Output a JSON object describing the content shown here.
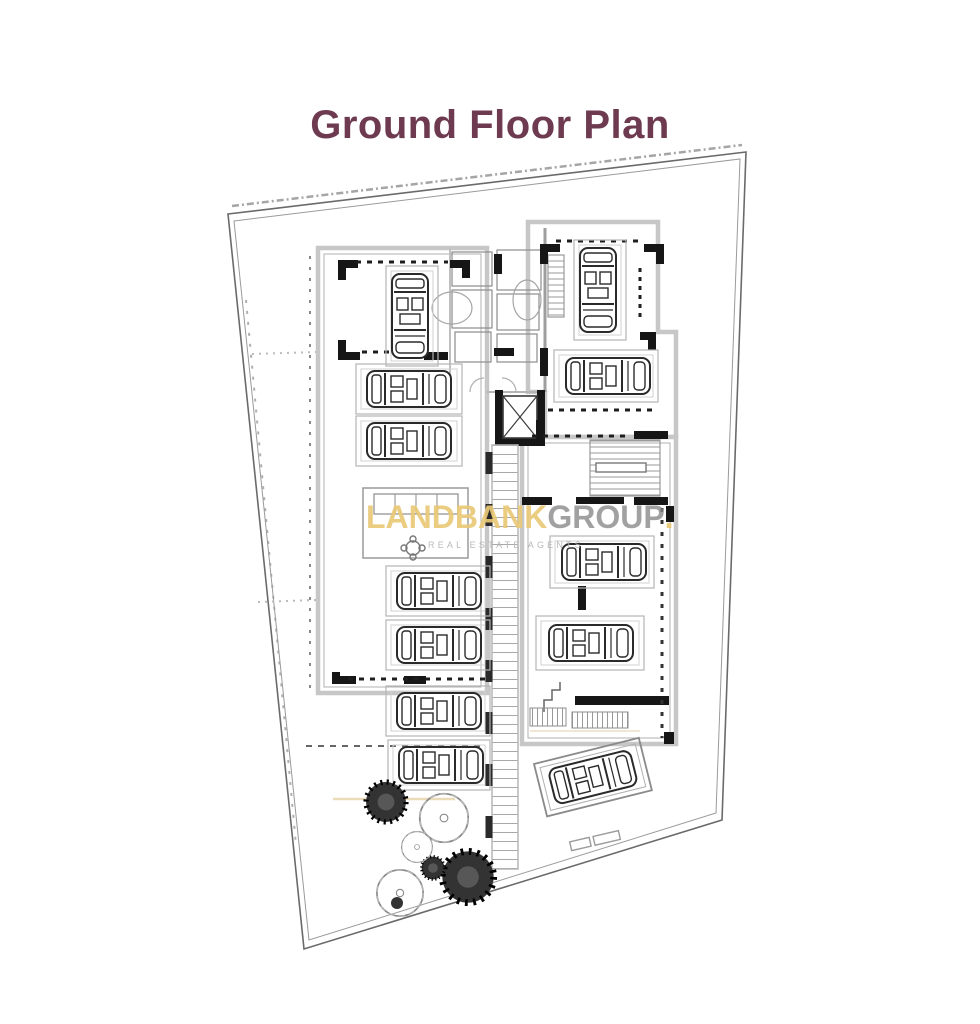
{
  "page": {
    "title": "Ground Floor Plan"
  },
  "watermark": {
    "brand_primary": "LANDBANK",
    "brand_secondary": "GROUP",
    "brand_suffix": ".",
    "tagline": "REAL ESTATE AGENTS"
  },
  "colors": {
    "title_text": "#6d3a50",
    "watermark_gold": "#e9c776",
    "watermark_gray": "#868686",
    "watermark_tagline_gray": "#b9b9b9",
    "plan_line_dark": "#222222",
    "plan_outline_gray": "#c7c7c7",
    "background": "#ffffff"
  },
  "plan": {
    "kind": "architectural-ground-floor-plan",
    "symbols": {
      "parking_cars": 12,
      "elevator_shafts": 1,
      "ramps": 1,
      "staircases": 2,
      "trees": 6
    }
  }
}
